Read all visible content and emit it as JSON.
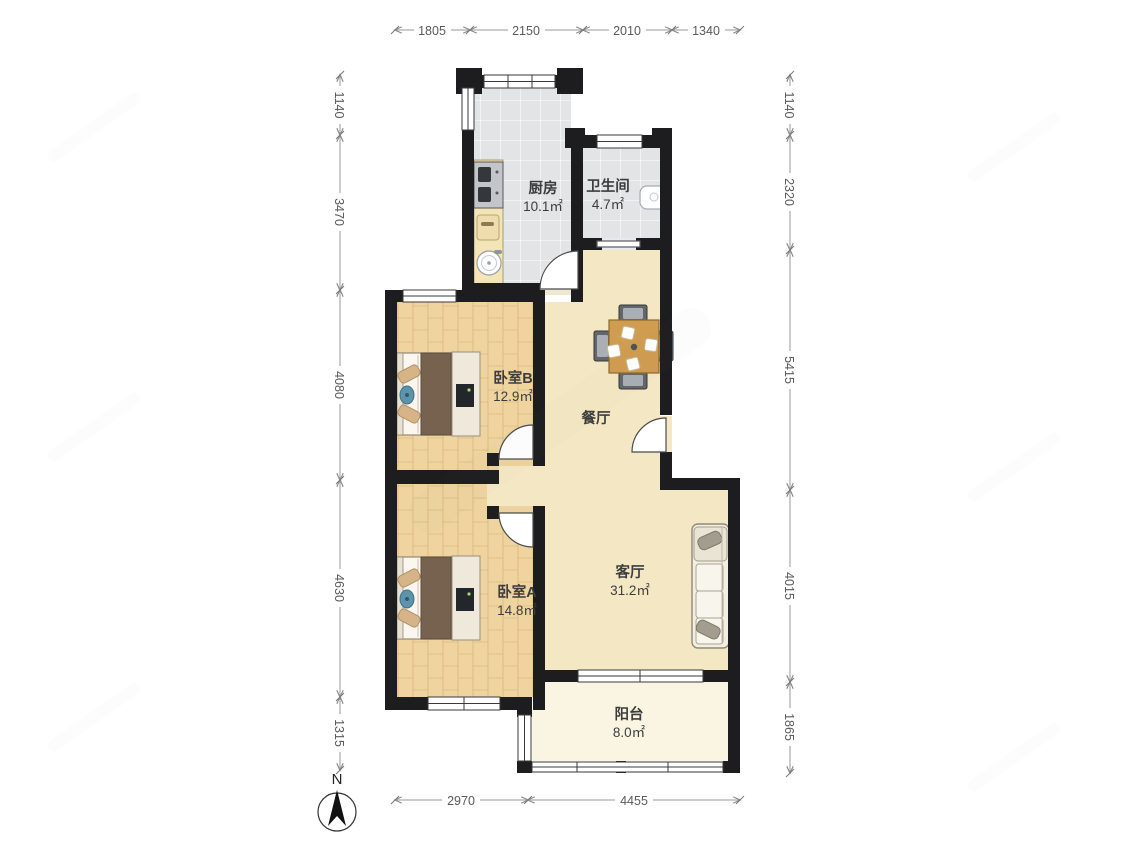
{
  "compass": {
    "label": "N"
  },
  "rooms": {
    "kitchen": {
      "name": "厨房",
      "area": "10.1㎡"
    },
    "bathroom": {
      "name": "卫生间",
      "area": "4.7㎡"
    },
    "bedroom_b": {
      "name": "卧室B",
      "area": "12.9㎡"
    },
    "dining": {
      "name": "餐厅"
    },
    "living": {
      "name": "客厅",
      "area": "31.2㎡"
    },
    "bedroom_a": {
      "name": "卧室A",
      "area": "14.8㎡"
    },
    "balcony": {
      "name": "阳台",
      "area": "8.0㎡"
    }
  },
  "dimensions_mm": {
    "top": [
      "1805",
      "2150",
      "2010",
      "1340"
    ],
    "left": [
      "1140",
      "3470",
      "4080",
      "4630",
      "1315"
    ],
    "right": [
      "1140",
      "2320",
      "5415",
      "4015",
      "1865"
    ],
    "bottom": [
      "2970",
      "4455"
    ]
  },
  "colors": {
    "wall": "#1d1d1f",
    "wood_floor": "#eed3a0",
    "tile_floor": "#e2e4e6",
    "open_floor": "#f4e8c4",
    "balcony_floor": "#f9f5e2",
    "dimension_text": "#5a5a5a",
    "label_text": "#3d3d3d"
  }
}
